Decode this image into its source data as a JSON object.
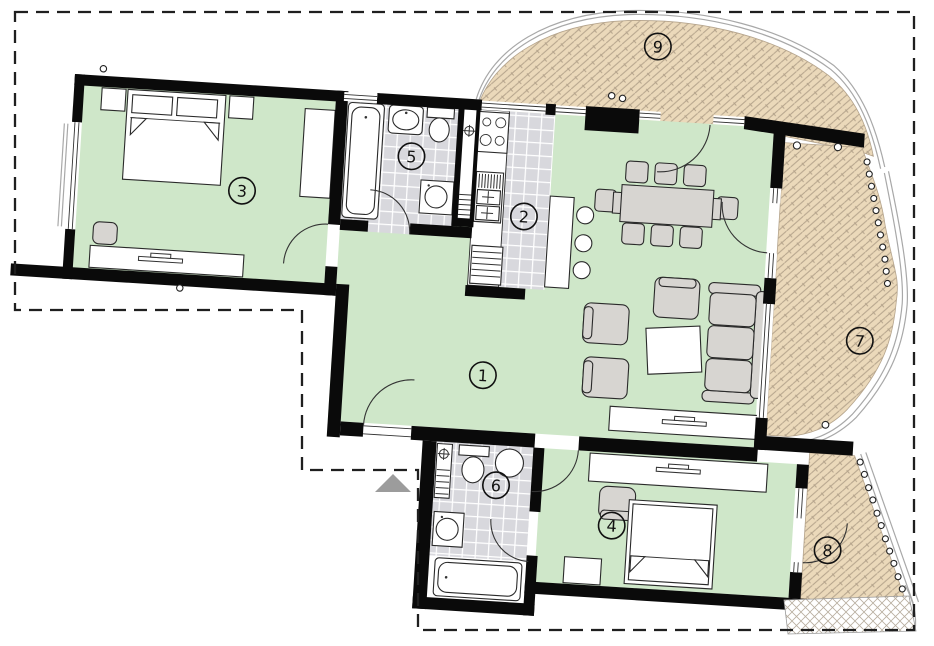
{
  "rooms": [
    {
      "number": "1"
    },
    {
      "number": "2"
    },
    {
      "number": "3"
    },
    {
      "number": "4"
    },
    {
      "number": "5"
    },
    {
      "number": "6"
    },
    {
      "number": "7"
    },
    {
      "number": "8"
    },
    {
      "number": "9"
    }
  ],
  "colors": {
    "room_fill": "#cfe7c9",
    "tile_fill": "#d8d8dd",
    "terrace_fill": "#ebd9ba",
    "terrace_joint": "#b5a48c",
    "wall": "#0a0a0a",
    "furniture_gray": "#d7d5d1",
    "outline": "#2a2a2a",
    "boundary": "#1f1f1f",
    "entry_arrow": "#9c9c9c",
    "band": "#a8a8a8"
  }
}
